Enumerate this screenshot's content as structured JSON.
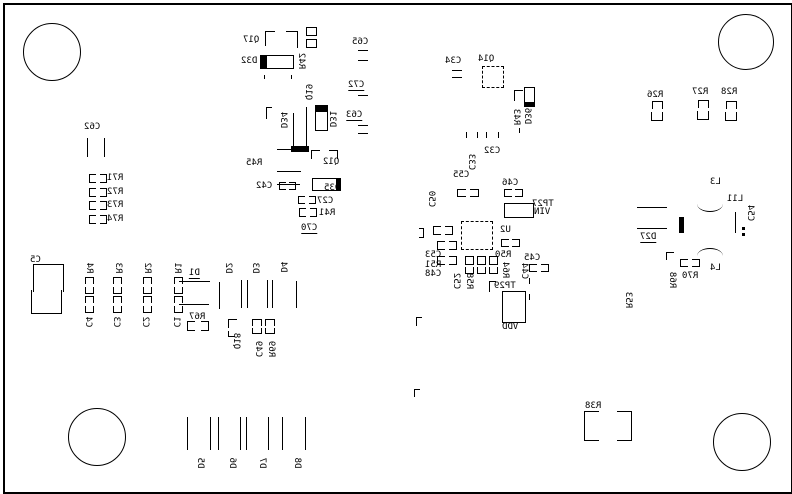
{
  "drawing": {
    "type": "pcb-silkscreen-bottom-view",
    "mirrored_text": true,
    "colors": {
      "background": "#ffffff",
      "silkscreen": "#000000"
    },
    "border": {
      "x": 3,
      "y": 3,
      "w": 786,
      "h": 487
    },
    "mounting_holes": [
      {
        "cx": 51,
        "cy": 51,
        "r": 28
      },
      {
        "cx": 745,
        "cy": 41,
        "r": 27
      },
      {
        "cx": 96,
        "cy": 436,
        "r": 28
      },
      {
        "cx": 741,
        "cy": 441,
        "r": 28
      }
    ],
    "labels": [
      {
        "t": "Q17",
        "x": 243,
        "y": 35
      },
      {
        "t": "D32",
        "x": 241,
        "y": 56
      },
      {
        "t": "R42",
        "x": 301,
        "y": 61,
        "v": 1
      },
      {
        "t": "Q19",
        "x": 308,
        "y": 92,
        "v": 1
      },
      {
        "t": "D34",
        "x": 283,
        "y": 120,
        "v": 1
      },
      {
        "t": "D31",
        "x": 332,
        "y": 119,
        "v": 1
      },
      {
        "t": "C65",
        "x": 352,
        "y": 37
      },
      {
        "t": "C72",
        "x": 348,
        "y": 80,
        "u": 1
      },
      {
        "t": "C63",
        "x": 346,
        "y": 110,
        "u": 1
      },
      {
        "t": "R45",
        "x": 246,
        "y": 158
      },
      {
        "t": "Q12",
        "x": 323,
        "y": 157
      },
      {
        "t": "D35",
        "x": 324,
        "y": 183
      },
      {
        "t": "C42",
        "x": 256,
        "y": 181
      },
      {
        "t": "C27",
        "x": 317,
        "y": 196
      },
      {
        "t": "R41",
        "x": 319,
        "y": 208
      },
      {
        "t": "C70",
        "x": 301,
        "y": 223,
        "u": 1
      },
      {
        "t": "C62",
        "x": 84,
        "y": 122
      },
      {
        "t": "R71",
        "x": 107,
        "y": 173
      },
      {
        "t": "R72",
        "x": 107,
        "y": 187
      },
      {
        "t": "R73",
        "x": 107,
        "y": 200
      },
      {
        "t": "R74",
        "x": 107,
        "y": 214
      },
      {
        "t": "C5",
        "x": 30,
        "y": 255
      },
      {
        "t": "R4",
        "x": 89,
        "y": 268,
        "v": 1
      },
      {
        "t": "R3",
        "x": 118,
        "y": 268,
        "v": 1
      },
      {
        "t": "R2",
        "x": 147,
        "y": 268,
        "v": 1
      },
      {
        "t": "R1",
        "x": 177,
        "y": 268,
        "v": 1
      },
      {
        "t": "C4",
        "x": 88,
        "y": 322,
        "v": 1
      },
      {
        "t": "C3",
        "x": 116,
        "y": 322,
        "v": 1
      },
      {
        "t": "C2",
        "x": 145,
        "y": 322,
        "v": 1
      },
      {
        "t": "C1",
        "x": 176,
        "y": 322,
        "v": 1
      },
      {
        "t": "D1",
        "x": 189,
        "y": 268,
        "u": 1
      },
      {
        "t": "R67",
        "x": 189,
        "y": 312
      },
      {
        "t": "D2",
        "x": 228,
        "y": 268,
        "v": 1
      },
      {
        "t": "D3",
        "x": 255,
        "y": 268,
        "v": 1
      },
      {
        "t": "D4",
        "x": 283,
        "y": 267,
        "v": 1
      },
      {
        "t": "Q18",
        "x": 236,
        "y": 341,
        "v": 1
      },
      {
        "t": "C49",
        "x": 258,
        "y": 349,
        "v": 1
      },
      {
        "t": "R69",
        "x": 271,
        "y": 349,
        "v": 1
      },
      {
        "t": "C34",
        "x": 445,
        "y": 56
      },
      {
        "t": "Q14",
        "x": 478,
        "y": 54
      },
      {
        "t": "R43",
        "x": 516,
        "y": 117,
        "v": 1
      },
      {
        "t": "D36",
        "x": 527,
        "y": 116,
        "v": 1
      },
      {
        "t": "C32",
        "x": 484,
        "y": 146
      },
      {
        "t": "C33",
        "x": 471,
        "y": 162,
        "v": 1
      },
      {
        "t": "C55",
        "x": 453,
        "y": 170
      },
      {
        "t": "C50",
        "x": 431,
        "y": 199,
        "v": 1
      },
      {
        "t": "C46",
        "x": 502,
        "y": 178
      },
      {
        "t": "U2",
        "x": 500,
        "y": 225
      },
      {
        "t": "R50",
        "x": 495,
        "y": 250
      },
      {
        "t": "R64",
        "x": 505,
        "y": 270,
        "v": 1
      },
      {
        "t": "C53",
        "x": 425,
        "y": 250
      },
      {
        "t": "R51",
        "x": 425,
        "y": 260
      },
      {
        "t": "C48",
        "x": 425,
        "y": 269
      },
      {
        "t": "C52",
        "x": 456,
        "y": 281,
        "v": 1
      },
      {
        "t": "R58",
        "x": 469,
        "y": 281,
        "v": 1
      },
      {
        "t": "C45",
        "x": 524,
        "y": 253
      },
      {
        "t": "C44",
        "x": 524,
        "y": 271,
        "v": 1
      },
      {
        "t": "TP29",
        "x": 494,
        "y": 281
      },
      {
        "t": "VDD",
        "x": 502,
        "y": 322
      },
      {
        "t": "TP27",
        "x": 532,
        "y": 199
      },
      {
        "t": "VIN",
        "x": 534,
        "y": 207
      },
      {
        "t": "R26",
        "x": 647,
        "y": 90
      },
      {
        "t": "R27",
        "x": 692,
        "y": 87
      },
      {
        "t": "R28",
        "x": 721,
        "y": 87
      },
      {
        "t": "L3",
        "x": 710,
        "y": 177
      },
      {
        "t": "L11",
        "x": 727,
        "y": 194
      },
      {
        "t": "C54",
        "x": 750,
        "y": 213,
        "v": 1
      },
      {
        "t": "D27",
        "x": 640,
        "y": 232,
        "u": 1
      },
      {
        "t": "L4",
        "x": 710,
        "y": 263
      },
      {
        "t": "R70",
        "x": 682,
        "y": 271
      },
      {
        "t": "R68",
        "x": 672,
        "y": 280,
        "v": 1
      },
      {
        "t": "R53",
        "x": 628,
        "y": 300,
        "v": 1
      },
      {
        "t": "R38",
        "x": 585,
        "y": 401
      },
      {
        "t": "D5",
        "x": 200,
        "y": 463,
        "v": 1
      },
      {
        "t": "D6",
        "x": 232,
        "y": 463,
        "v": 1
      },
      {
        "t": "D7",
        "x": 262,
        "y": 463,
        "v": 1
      },
      {
        "t": "D8",
        "x": 297,
        "y": 463,
        "v": 1
      }
    ],
    "outlines": [
      {
        "x": 266,
        "y": 55,
        "w": 28,
        "h": 14,
        "s": "ltrb"
      },
      {
        "x": 315,
        "y": 111,
        "w": 13,
        "h": 20,
        "s": "ltrb"
      },
      {
        "x": 312,
        "y": 178,
        "w": 25,
        "h": 13,
        "s": "ltrb"
      },
      {
        "x": 524,
        "y": 87,
        "w": 11,
        "h": 20,
        "s": "ltrb"
      },
      {
        "x": 482,
        "y": 66,
        "w": 22,
        "h": 22,
        "s": "dash"
      },
      {
        "x": 461,
        "y": 221,
        "w": 32,
        "h": 29,
        "s": "dash"
      },
      {
        "x": 504,
        "y": 203,
        "w": 30,
        "h": 15,
        "s": "ltrb"
      },
      {
        "x": 502,
        "y": 291,
        "w": 24,
        "h": 32,
        "s": "ltrb"
      },
      {
        "x": 33,
        "y": 264,
        "w": 31,
        "h": 28,
        "s": "ltr"
      },
      {
        "x": 31,
        "y": 290,
        "w": 31,
        "h": 24,
        "s": "lbr"
      },
      {
        "x": 306,
        "y": 27,
        "w": 11,
        "h": 9,
        "s": "ltrb"
      },
      {
        "x": 306,
        "y": 39,
        "w": 11,
        "h": 9,
        "s": "ltrb"
      },
      {
        "x": 465,
        "y": 256,
        "w": 9,
        "h": 9,
        "s": "ltrb"
      },
      {
        "x": 477,
        "y": 256,
        "w": 9,
        "h": 9,
        "s": "ltrb"
      },
      {
        "x": 489,
        "y": 256,
        "w": 9,
        "h": 9,
        "s": "ltrb"
      },
      {
        "x": 465,
        "y": 267,
        "w": 9,
        "h": 7,
        "s": "lrb"
      },
      {
        "x": 477,
        "y": 267,
        "w": 9,
        "h": 7,
        "s": "lrb"
      },
      {
        "x": 489,
        "y": 267,
        "w": 9,
        "h": 7,
        "s": "lrb"
      },
      {
        "x": 584,
        "y": 411,
        "w": 15,
        "h": 30,
        "s": "ltb"
      },
      {
        "x": 617,
        "y": 411,
        "w": 15,
        "h": 30,
        "s": "rtb"
      },
      {
        "x": 265,
        "y": 31,
        "w": 10,
        "h": 15,
        "s": "lt"
      },
      {
        "x": 286,
        "y": 31,
        "w": 12,
        "h": 17,
        "s": "tr"
      },
      {
        "x": 311,
        "y": 150,
        "w": 9,
        "h": 9,
        "s": "lt"
      },
      {
        "x": 329,
        "y": 150,
        "w": 9,
        "h": 9,
        "s": "tr"
      },
      {
        "x": 89,
        "y": 174,
        "w": 7,
        "h": 9,
        "s": "ltb"
      },
      {
        "x": 100,
        "y": 174,
        "w": 7,
        "h": 9,
        "s": "rtb"
      },
      {
        "x": 89,
        "y": 188,
        "w": 7,
        "h": 9,
        "s": "ltb"
      },
      {
        "x": 100,
        "y": 188,
        "w": 7,
        "h": 9,
        "s": "rtb"
      },
      {
        "x": 89,
        "y": 201,
        "w": 7,
        "h": 9,
        "s": "ltb"
      },
      {
        "x": 100,
        "y": 201,
        "w": 7,
        "h": 9,
        "s": "rtb"
      },
      {
        "x": 89,
        "y": 215,
        "w": 7,
        "h": 9,
        "s": "ltb"
      },
      {
        "x": 100,
        "y": 215,
        "w": 7,
        "h": 9,
        "s": "rtb"
      },
      {
        "x": 652,
        "y": 101,
        "w": 11,
        "h": 8,
        "s": "ltr"
      },
      {
        "x": 651,
        "y": 112,
        "w": 12,
        "h": 9,
        "s": "lbr"
      },
      {
        "x": 698,
        "y": 100,
        "w": 11,
        "h": 8,
        "s": "ltr"
      },
      {
        "x": 697,
        "y": 111,
        "w": 12,
        "h": 9,
        "s": "lbr"
      },
      {
        "x": 726,
        "y": 101,
        "w": 11,
        "h": 8,
        "s": "ltr"
      },
      {
        "x": 725,
        "y": 112,
        "w": 12,
        "h": 9,
        "s": "lbr"
      },
      {
        "x": 85,
        "y": 277,
        "w": 9,
        "h": 7,
        "s": "ltr"
      },
      {
        "x": 85,
        "y": 287,
        "w": 9,
        "h": 7,
        "s": "lbr"
      },
      {
        "x": 85,
        "y": 296,
        "w": 9,
        "h": 7,
        "s": "ltr"
      },
      {
        "x": 85,
        "y": 306,
        "w": 9,
        "h": 7,
        "s": "lbr"
      },
      {
        "x": 113,
        "y": 277,
        "w": 9,
        "h": 7,
        "s": "ltr"
      },
      {
        "x": 113,
        "y": 287,
        "w": 9,
        "h": 7,
        "s": "lbr"
      },
      {
        "x": 113,
        "y": 296,
        "w": 9,
        "h": 7,
        "s": "ltr"
      },
      {
        "x": 113,
        "y": 306,
        "w": 9,
        "h": 7,
        "s": "lbr"
      },
      {
        "x": 143,
        "y": 277,
        "w": 9,
        "h": 7,
        "s": "ltr"
      },
      {
        "x": 143,
        "y": 287,
        "w": 9,
        "h": 7,
        "s": "lbr"
      },
      {
        "x": 143,
        "y": 296,
        "w": 9,
        "h": 7,
        "s": "ltr"
      },
      {
        "x": 143,
        "y": 306,
        "w": 9,
        "h": 7,
        "s": "lbr"
      },
      {
        "x": 174,
        "y": 277,
        "w": 9,
        "h": 7,
        "s": "ltr"
      },
      {
        "x": 174,
        "y": 287,
        "w": 9,
        "h": 7,
        "s": "lbr"
      },
      {
        "x": 174,
        "y": 296,
        "w": 9,
        "h": 7,
        "s": "ltr"
      },
      {
        "x": 174,
        "y": 306,
        "w": 9,
        "h": 7,
        "s": "lbr"
      },
      {
        "x": 279,
        "y": 182,
        "w": 7,
        "h": 8,
        "s": "ltb"
      },
      {
        "x": 289,
        "y": 182,
        "w": 7,
        "h": 8,
        "s": "rtb"
      },
      {
        "x": 298,
        "y": 196,
        "w": 7,
        "h": 8,
        "s": "ltb"
      },
      {
        "x": 309,
        "y": 196,
        "w": 7,
        "h": 8,
        "s": "rtb"
      },
      {
        "x": 299,
        "y": 208,
        "w": 7,
        "h": 9,
        "s": "ltb"
      },
      {
        "x": 310,
        "y": 208,
        "w": 7,
        "h": 9,
        "s": "rtb"
      },
      {
        "x": 187,
        "y": 321,
        "w": 8,
        "h": 10,
        "s": "ltb"
      },
      {
        "x": 201,
        "y": 321,
        "w": 8,
        "h": 10,
        "s": "rtb"
      },
      {
        "x": 228,
        "y": 319,
        "w": 9,
        "h": 9,
        "s": "lt"
      },
      {
        "x": 228,
        "y": 331,
        "w": 7,
        "h": 6,
        "s": "lb"
      },
      {
        "x": 252,
        "y": 319,
        "w": 10,
        "h": 7,
        "s": "ltr"
      },
      {
        "x": 265,
        "y": 319,
        "w": 10,
        "h": 7,
        "s": "ltr"
      },
      {
        "x": 252,
        "y": 328,
        "w": 10,
        "h": 6,
        "s": "lbr"
      },
      {
        "x": 265,
        "y": 328,
        "w": 10,
        "h": 6,
        "s": "lbr"
      },
      {
        "x": 504,
        "y": 189,
        "w": 8,
        "h": 8,
        "s": "ltb"
      },
      {
        "x": 515,
        "y": 189,
        "w": 8,
        "h": 8,
        "s": "rtb"
      },
      {
        "x": 457,
        "y": 189,
        "w": 9,
        "h": 8,
        "s": "ltb"
      },
      {
        "x": 470,
        "y": 189,
        "w": 9,
        "h": 8,
        "s": "rtb"
      },
      {
        "x": 501,
        "y": 239,
        "w": 8,
        "h": 8,
        "s": "ltb"
      },
      {
        "x": 512,
        "y": 239,
        "w": 8,
        "h": 8,
        "s": "rtb"
      },
      {
        "x": 529,
        "y": 264,
        "w": 8,
        "h": 8,
        "s": "ltb"
      },
      {
        "x": 541,
        "y": 264,
        "w": 8,
        "h": 8,
        "s": "rtb"
      },
      {
        "x": 433,
        "y": 226,
        "w": 8,
        "h": 9,
        "s": "ltb"
      },
      {
        "x": 445,
        "y": 226,
        "w": 8,
        "h": 9,
        "s": "rtb"
      },
      {
        "x": 437,
        "y": 241,
        "w": 8,
        "h": 9,
        "s": "ltb"
      },
      {
        "x": 449,
        "y": 241,
        "w": 8,
        "h": 9,
        "s": "rtb"
      },
      {
        "x": 437,
        "y": 256,
        "w": 8,
        "h": 9,
        "s": "ltb"
      },
      {
        "x": 449,
        "y": 256,
        "w": 8,
        "h": 9,
        "s": "rtb"
      },
      {
        "x": 419,
        "y": 228,
        "w": 5,
        "h": 10,
        "s": "rtb"
      },
      {
        "x": 489,
        "y": 281,
        "w": 7,
        "h": 11,
        "s": "lt"
      },
      {
        "x": 666,
        "y": 252,
        "w": 8,
        "h": 8,
        "s": "lt"
      },
      {
        "x": 680,
        "y": 259,
        "w": 8,
        "h": 8,
        "s": "ltb"
      },
      {
        "x": 692,
        "y": 259,
        "w": 8,
        "h": 8,
        "s": "rtb"
      },
      {
        "x": 416,
        "y": 317,
        "w": 6,
        "h": 9,
        "s": "lt"
      },
      {
        "x": 414,
        "y": 389,
        "w": 6,
        "h": 8,
        "s": "lt"
      },
      {
        "x": 266,
        "y": 107,
        "w": 6,
        "h": 12,
        "s": "lt"
      },
      {
        "x": 514,
        "y": 90,
        "w": 9,
        "h": 11,
        "s": "lt"
      }
    ],
    "filled_marks": [
      {
        "x": 260,
        "y": 55,
        "w": 6,
        "h": 14
      },
      {
        "x": 291,
        "y": 146,
        "w": 18,
        "h": 6
      },
      {
        "x": 315,
        "y": 105,
        "w": 13,
        "h": 6
      },
      {
        "x": 336,
        "y": 178,
        "w": 5,
        "h": 13
      },
      {
        "x": 524,
        "y": 102,
        "w": 11,
        "h": 5
      },
      {
        "x": 679,
        "y": 217,
        "w": 5,
        "h": 16
      },
      {
        "x": 742,
        "y": 227,
        "w": 3,
        "h": 3
      },
      {
        "x": 742,
        "y": 233,
        "w": 3,
        "h": 3
      }
    ],
    "hlines": [
      [
        452,
        70,
        10
      ],
      [
        452,
        77,
        10
      ],
      [
        277,
        149,
        24
      ],
      [
        277,
        171,
        24
      ],
      [
        277,
        184,
        23
      ],
      [
        179,
        281,
        31
      ],
      [
        179,
        304,
        30
      ],
      [
        637,
        207,
        30
      ],
      [
        637,
        228,
        30
      ],
      [
        358,
        50,
        10
      ],
      [
        358,
        60,
        10
      ],
      [
        358,
        95,
        10
      ],
      [
        358,
        125,
        10
      ],
      [
        358,
        133,
        10
      ]
    ],
    "vlines": [
      [
        87,
        138,
        19
      ],
      [
        104,
        138,
        19
      ],
      [
        293,
        113,
        35
      ],
      [
        306,
        107,
        41
      ],
      [
        219,
        282,
        27
      ],
      [
        241,
        280,
        28
      ],
      [
        247,
        280,
        28
      ],
      [
        267,
        280,
        28
      ],
      [
        272,
        280,
        28
      ],
      [
        296,
        281,
        27
      ],
      [
        187,
        417,
        33
      ],
      [
        210,
        417,
        33
      ],
      [
        218,
        417,
        33
      ],
      [
        240,
        417,
        33
      ],
      [
        246,
        417,
        33
      ],
      [
        268,
        417,
        33
      ],
      [
        282,
        417,
        33
      ],
      [
        305,
        417,
        33
      ],
      [
        735,
        212,
        21
      ],
      [
        264,
        75,
        4
      ],
      [
        291,
        75,
        4
      ],
      [
        519,
        128,
        5
      ],
      [
        529,
        278,
        6
      ],
      [
        529,
        294,
        6
      ],
      [
        466,
        132,
        6
      ],
      [
        477,
        132,
        6
      ],
      [
        486,
        132,
        6
      ],
      [
        498,
        132,
        6
      ]
    ],
    "arcs": [
      {
        "x": 697,
        "y": 204,
        "w": 26,
        "h": 8,
        "dir": "up"
      },
      {
        "x": 697,
        "y": 248,
        "w": 26,
        "h": 8,
        "dir": "down"
      }
    ]
  }
}
